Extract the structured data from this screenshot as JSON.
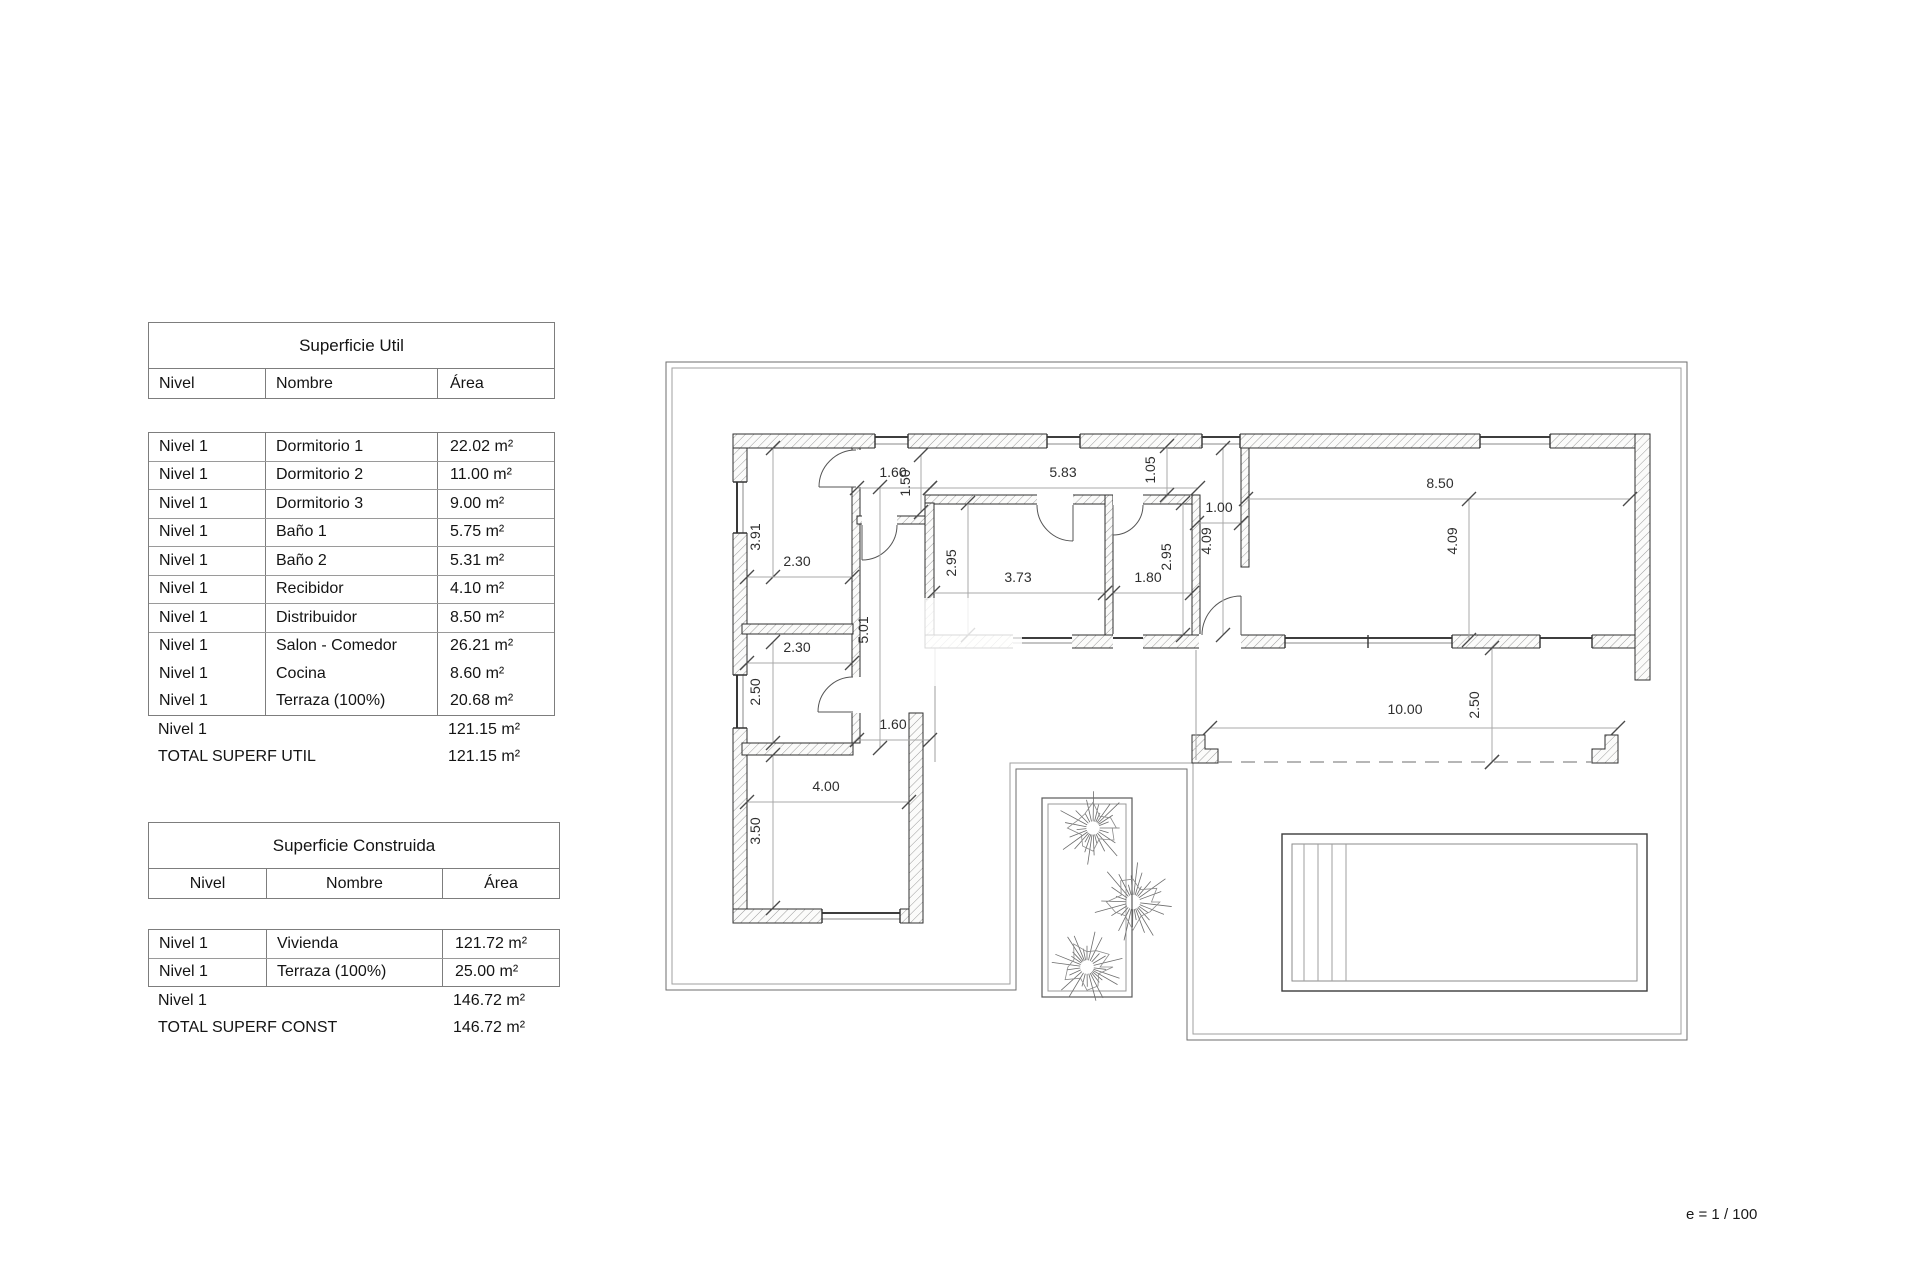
{
  "plan": {
    "scale_note": "e = 1 / 100",
    "dimensions": [
      {
        "v": "1.60",
        "x": 893,
        "y": 477,
        "rot": 0,
        "line": [
          857,
          488,
          930,
          488
        ]
      },
      {
        "v": "5.83",
        "x": 1063,
        "y": 477,
        "rot": 0,
        "line": [
          930,
          488,
          1198,
          488
        ]
      },
      {
        "v": "1.50",
        "x": 910,
        "y": 483,
        "rot": -90,
        "line": [
          921,
          455,
          921,
          512
        ]
      },
      {
        "v": "1.05",
        "x": 1155,
        "y": 470,
        "rot": -90,
        "line": [
          1167,
          446,
          1167,
          495
        ]
      },
      {
        "v": "1.00",
        "x": 1219,
        "y": 512,
        "rot": 0,
        "line": [
          1197,
          523,
          1241,
          523
        ]
      },
      {
        "v": "8.50",
        "x": 1440,
        "y": 488,
        "rot": 0,
        "line": [
          1246,
          499,
          1630,
          499
        ]
      },
      {
        "v": "4.09",
        "x": 1211,
        "y": 541,
        "rot": -90,
        "line": [
          1223,
          448,
          1223,
          635
        ]
      },
      {
        "v": "4.09",
        "x": 1457,
        "y": 541,
        "rot": -90,
        "line": [
          1469,
          499,
          1469,
          640
        ]
      },
      {
        "v": "3.91",
        "x": 760,
        "y": 537,
        "rot": -90,
        "line": [
          773,
          448,
          773,
          577
        ]
      },
      {
        "v": "2.30",
        "x": 797,
        "y": 566,
        "rot": 0,
        "line": [
          747,
          577,
          852,
          577
        ]
      },
      {
        "v": "2.95",
        "x": 956,
        "y": 563,
        "rot": -90,
        "line": [
          968,
          503,
          968,
          635
        ]
      },
      {
        "v": "3.73",
        "x": 1018,
        "y": 582,
        "rot": 0,
        "line": [
          933,
          593,
          1105,
          593
        ]
      },
      {
        "v": "1.80",
        "x": 1148,
        "y": 582,
        "rot": 0,
        "line": [
          1113,
          593,
          1192,
          593
        ]
      },
      {
        "v": "2.95",
        "x": 1171,
        "y": 557,
        "rot": -90,
        "line": [
          1183,
          503,
          1183,
          635
        ]
      },
      {
        "v": "2.30",
        "x": 797,
        "y": 652,
        "rot": 0,
        "line": [
          747,
          663,
          852,
          663
        ]
      },
      {
        "v": "5.01",
        "x": 868,
        "y": 630,
        "rot": -90,
        "line": [
          880,
          487,
          880,
          748
        ]
      },
      {
        "v": "2.50",
        "x": 760,
        "y": 692,
        "rot": -90,
        "line": [
          773,
          642,
          773,
          743
        ]
      },
      {
        "v": "1.60",
        "x": 893,
        "y": 729,
        "rot": 0,
        "line": [
          857,
          740,
          930,
          740
        ]
      },
      {
        "v": "4.00",
        "x": 826,
        "y": 791,
        "rot": 0,
        "line": [
          747,
          802,
          909,
          802
        ]
      },
      {
        "v": "3.50",
        "x": 760,
        "y": 831,
        "rot": -90,
        "line": [
          773,
          755,
          773,
          908
        ]
      },
      {
        "v": "10.00",
        "x": 1405,
        "y": 714,
        "rot": 0,
        "line": [
          1210,
          728,
          1618,
          728
        ]
      },
      {
        "v": "2.50",
        "x": 1479,
        "y": 705,
        "rot": -90,
        "line": [
          1492,
          648,
          1492,
          762
        ]
      }
    ]
  },
  "tables": {
    "util": {
      "title": "Superficie Util",
      "columns": [
        "Nivel",
        "Nombre",
        "Área"
      ],
      "rows": [
        [
          "Nivel 1",
          "Dormitorio 1",
          "22.02 m²"
        ],
        [
          "Nivel 1",
          "Dormitorio 2",
          "11.00 m²"
        ],
        [
          "Nivel 1",
          "Dormitorio 3",
          "9.00 m²"
        ],
        [
          "Nivel 1",
          "Baño 1",
          "5.75 m²"
        ],
        [
          "Nivel 1",
          "Baño 2",
          "5.31 m²"
        ],
        [
          "Nivel 1",
          "Recibidor",
          "4.10 m²"
        ],
        [
          "Nivel 1",
          "Distribuidor",
          "8.50 m²"
        ],
        [
          "Nivel 1",
          "Salon - Comedor",
          "26.21 m²"
        ],
        [
          "Nivel 1",
          "Cocina",
          "8.60 m²"
        ],
        [
          "Nivel 1",
          "Terraza (100%)",
          "20.68 m²"
        ]
      ],
      "subtotal": [
        "Nivel 1",
        "",
        "121.15 m²"
      ],
      "total": [
        "TOTAL SUPERF UTIL",
        "121.15 m²"
      ]
    },
    "construida": {
      "title": "Superficie Construida",
      "columns": [
        "Nivel",
        "Nombre",
        "Área"
      ],
      "rows": [
        [
          "Nivel 1",
          "Vivienda",
          "121.72 m²"
        ],
        [
          "Nivel 1",
          "Terraza (100%)",
          "25.00 m²"
        ]
      ],
      "subtotal": [
        "Nivel 1",
        "",
        "146.72 m²"
      ],
      "total": [
        "TOTAL SUPERF CONST",
        "146.72 m²"
      ]
    }
  }
}
